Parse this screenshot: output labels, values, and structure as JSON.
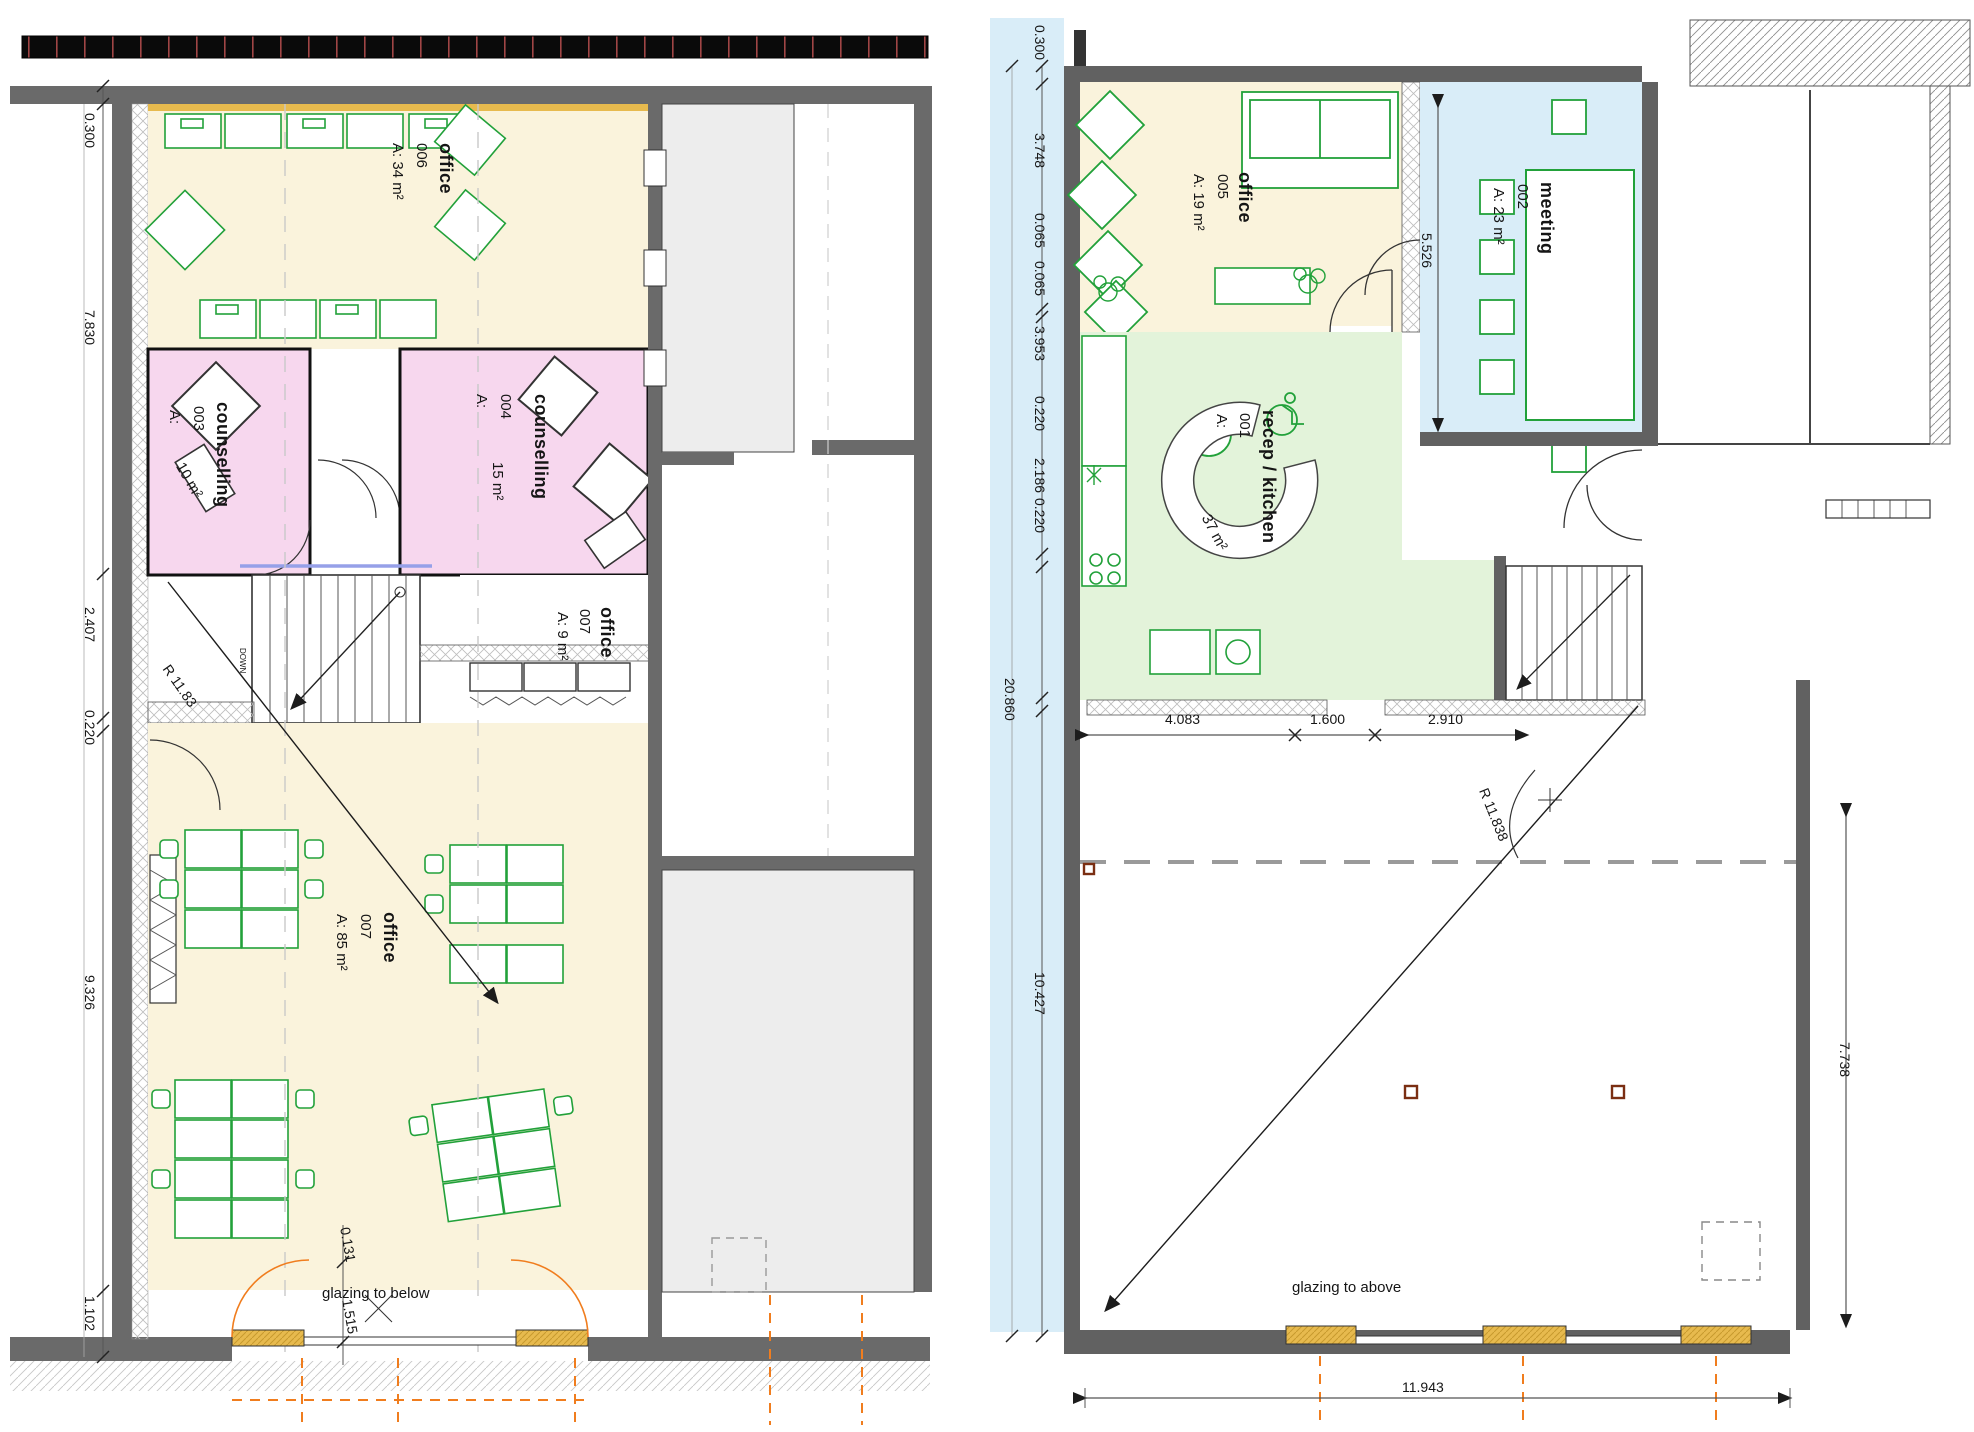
{
  "drawing": {
    "type": "architectural floor plans, two levels side by side",
    "colors": {
      "office_fill": "#FAF3DC",
      "counselling_fill": "#F7D7EE",
      "meeting_fill": "#D9EDF8",
      "recep_kitchen_fill": "#E3F3DA",
      "wall_grey": "#636363",
      "furniture_green": "#22A13A",
      "accent_orange": "#F07D1E",
      "glazing_gold": "#E7BA4E"
    }
  },
  "left_plan": {
    "labels": {
      "dim_0300": "0.300",
      "dim_7830": "7.830",
      "dim_2407": "2.407",
      "dim_0220": "0.220",
      "dim_9326": "9.326",
      "dim_1102": "1.102",
      "dim_0131": "0.131",
      "dim_1515": "1.515",
      "radius": "R 11.83",
      "glazing": "glazing to below",
      "down": "DOWN",
      "o6_name": "office",
      "o6_num": "006",
      "o6_area": "A: 34 m²",
      "c3_name": "counselling",
      "c3_num": "003",
      "c3_a": "A:",
      "c3_area": "10 m²",
      "c4_name": "counselling",
      "c4_num": "004",
      "c4_a": "A:",
      "c4_area": "15 m²",
      "o7s_name": "office",
      "o7s_num": "007",
      "o7s_area": "A: 9 m²",
      "o7_name": "office",
      "o7_num": "007",
      "o7_area": "A: 85 m²"
    }
  },
  "right_plan": {
    "labels": {
      "dim_0300": "0.300",
      "dim_3748": "3.748",
      "dim_0065a": "0.065",
      "dim_0065b": "0.065",
      "dim_3953": "3.953",
      "dim_0220a": "0.220",
      "dim_2186": "2.186",
      "dim_0220b": "0.220",
      "dim_20860": "20.860",
      "dim_10427": "10.427",
      "dim_5526": "5.526",
      "dim_4083": "4.083",
      "dim_1600": "1.600",
      "dim_2910": "2.910",
      "dim_7738": "7.738",
      "dim_11943": "11.943",
      "radius": "R 11.838",
      "glazing": "glazing to above",
      "o5_name": "office",
      "o5_num": "005",
      "o5_area": "A: 19 m²",
      "m2_name": "meeting",
      "m2_num": "002",
      "m2_area": "A: 23 m²",
      "rk_name": "recep / kitchen",
      "rk_num": "001",
      "rk_a": "A:",
      "rk_area": "37 m²"
    }
  }
}
